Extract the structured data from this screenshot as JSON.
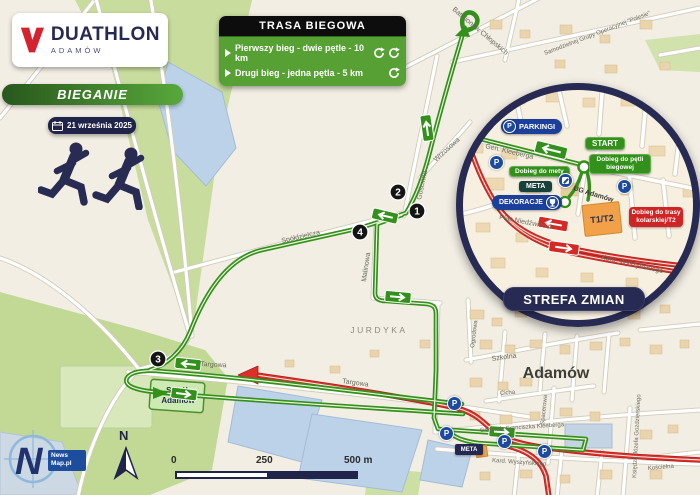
{
  "brand": {
    "mark": "V",
    "title": "DUATHLON",
    "subtitle": "ADAMÓW"
  },
  "event": {
    "category": "BIEGANIE",
    "date": "21 września 2025"
  },
  "legend": {
    "title": "TRASA BIEGOWA",
    "item1": "Pierwszy bieg - dwie pętle - 10 km",
    "item2": "Drugi bieg - jedna pętla - 5 km"
  },
  "inset": {
    "title": "STREFA ZMIAN",
    "p_letter": "P",
    "badges": {
      "parkingi": "PARKINGI",
      "start": "START",
      "dobieg_petli": "Dobieg do pętli biegowej",
      "dobieg_mety": "Dobieg do mety",
      "meta": "META",
      "dekoracje": "DEKORACJE",
      "t1t2": "T1/T2",
      "dobieg_trasy": "Dobieg do trasy kolarskiej/T2"
    },
    "streets": {
      "kleeberga": "Gen. Kleeberga",
      "plac_niedzwiedzi": "Plac Niedźwiedzi",
      "wyszynskiego": "Kard. Wyszyńskiego",
      "ug_adamow": "UG Adamów"
    }
  },
  "map": {
    "town": "Adamów",
    "district": "JURDYKA",
    "stadium_line1": "Sokół",
    "stadium_line2": "Adamów",
    "meta_badge": "META",
    "p_letter": "P",
    "markers": [
      "1",
      "2",
      "3",
      "4"
    ],
    "streets": {
      "batalionow": "Batalionów Chłopskich",
      "samodzielnej": "Samodzielnej Grupy Operacyjnej \"Polesie\"",
      "goscinna": "Gościnna",
      "wrzosowa": "Wrzosowa",
      "spoldzielcza": "Spółdzielcza",
      "malinowa": "Malinowa",
      "targowa": "Targowa",
      "ogrodowa": "Ogrodowa",
      "szkolna": "Szkolna",
      "cicha": "Cicha",
      "spacerowa": "Spacerowa",
      "kleeberga_full": "Generała Franciszka Kleeberga",
      "wyszynskiego": "Kard. Wyszyńskiego",
      "gostynskiego": "Księdza Józefa Gozdzierskiego",
      "koscielna": "Kościelna"
    }
  },
  "scalebar": {
    "start": "0",
    "mid": "250",
    "end": "500 m"
  },
  "compass": {
    "north": "N"
  },
  "credit": {
    "mark": "N",
    "line1": "News",
    "line2": "Map.pl"
  }
}
